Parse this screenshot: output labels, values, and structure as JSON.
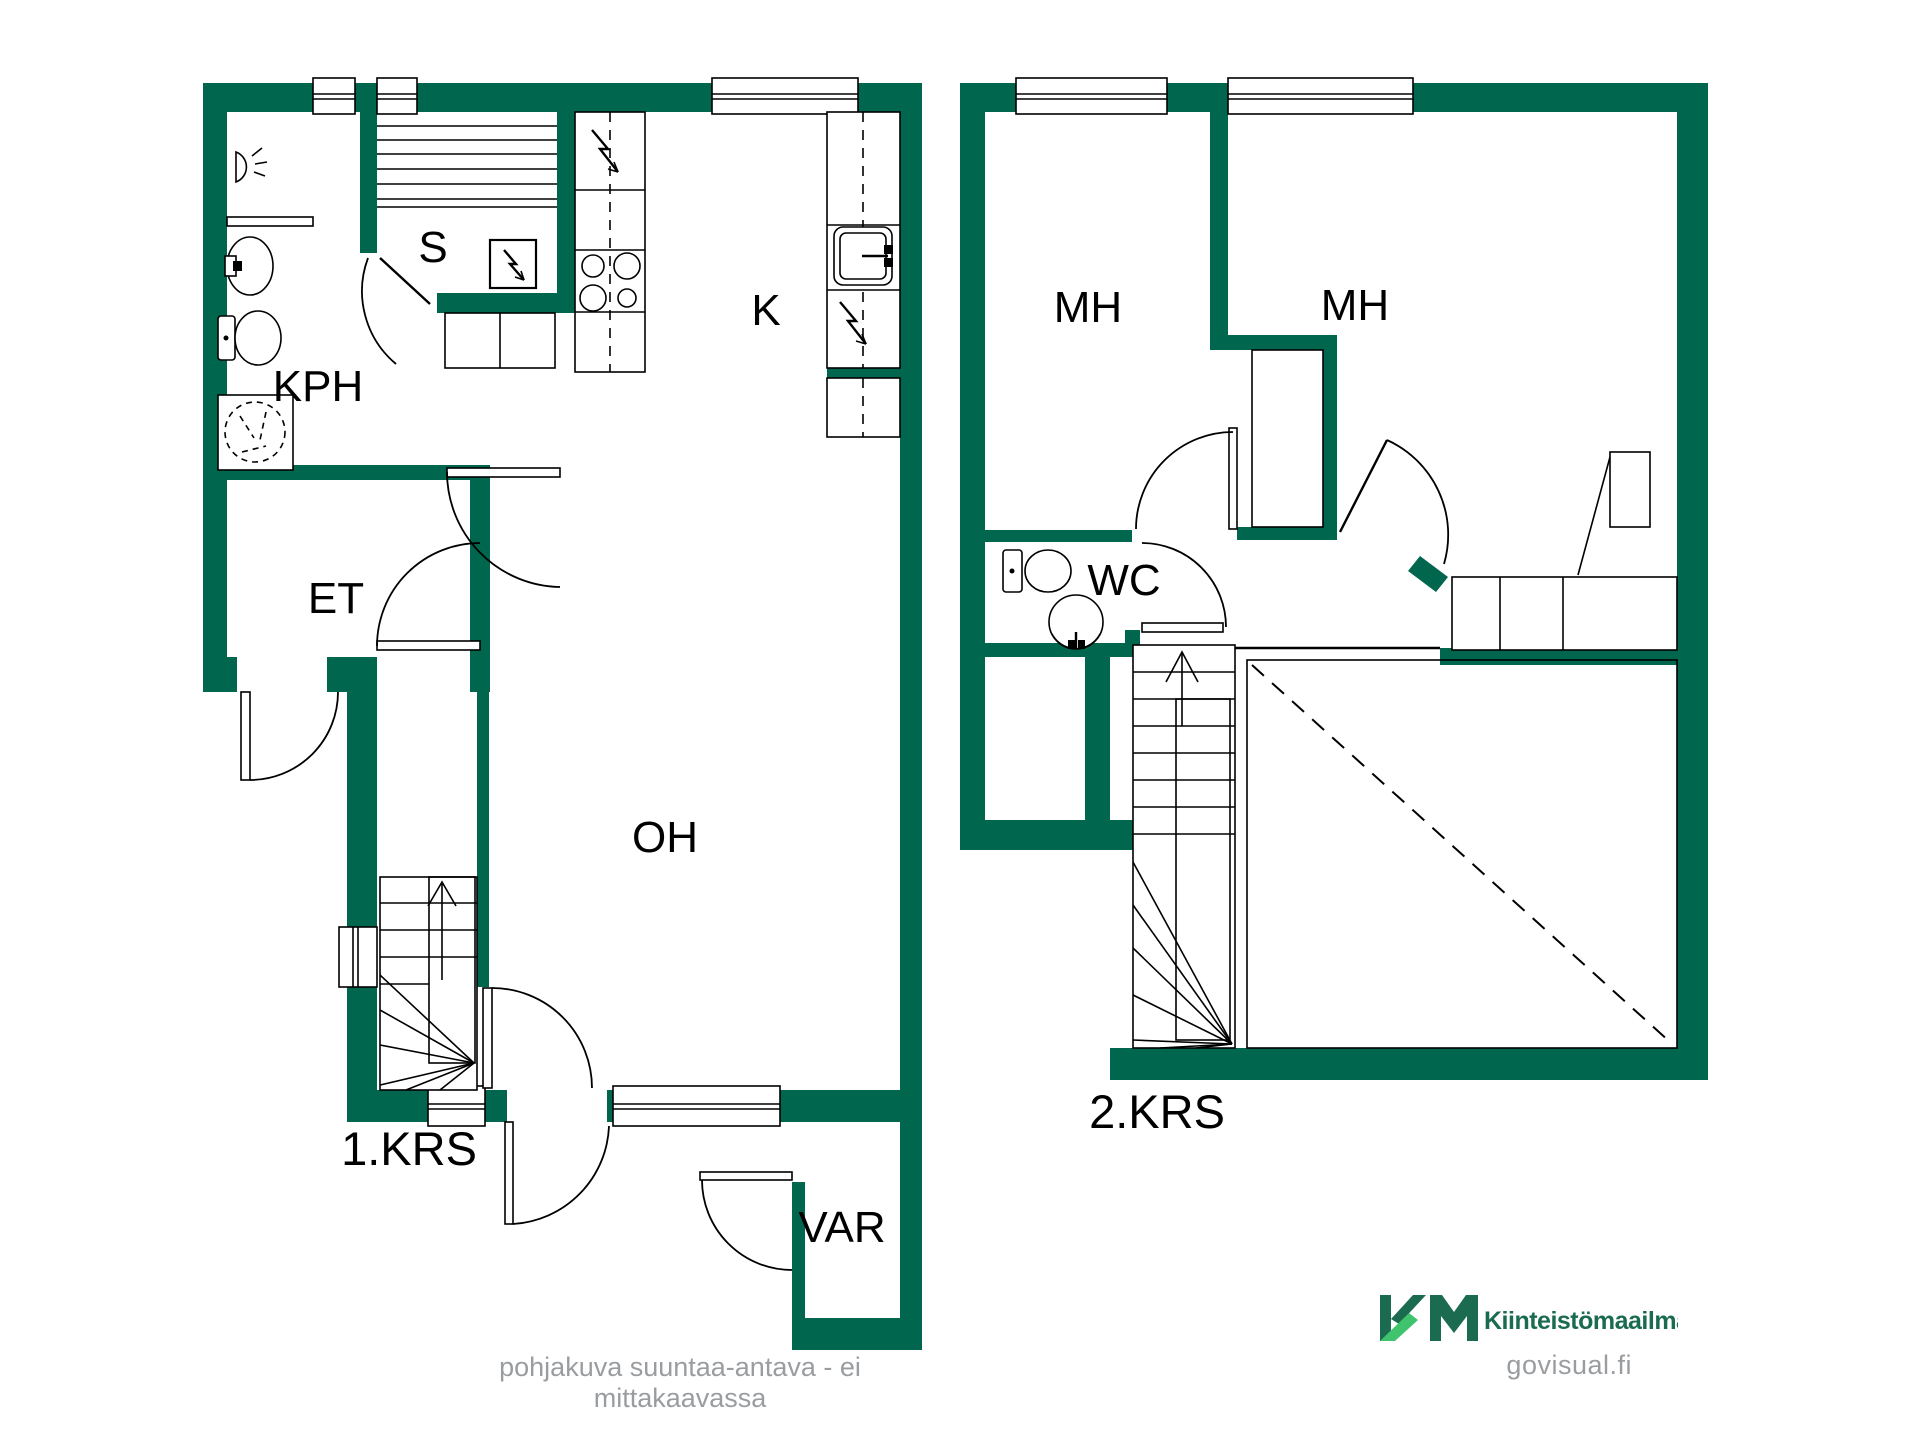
{
  "floors": [
    {
      "label": "1.KRS",
      "rooms": {
        "kph": "KPH",
        "sauna": "S",
        "kitchen": "K",
        "hall": "ET",
        "living": "OH",
        "storage": "VAR"
      }
    },
    {
      "label": "2.KRS",
      "rooms": {
        "bedroom_left": "MH",
        "bedroom_right": "MH",
        "wc": "WC"
      }
    }
  ],
  "footer": {
    "disclaimer": "pohjakuva suuntaa-antava - ei mittakaavassa",
    "watermark": "govisual.fi"
  },
  "branding": {
    "logo_text": "Kiinteistömaailma"
  },
  "colors": {
    "wall": "#00664e",
    "logo_dark": "#1b6b50",
    "logo_light": "#3fc46d",
    "muted": "#9a9da0"
  }
}
